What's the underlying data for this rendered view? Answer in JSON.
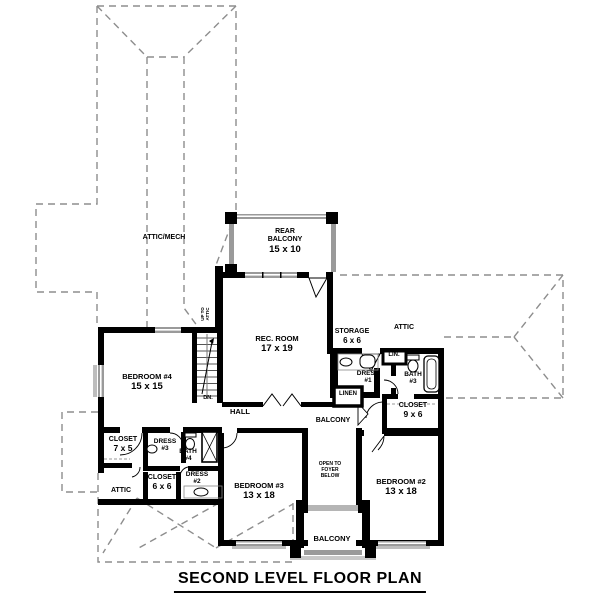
{
  "title": "SECOND LEVEL FLOOR PLAN",
  "colors": {
    "wall": "#000000",
    "window": "#9a9a9a",
    "railing": "#9a9a9a",
    "roof_dash": "#8d8d8d",
    "text": "#000000",
    "background": "#ffffff"
  },
  "plan": {
    "rooms": {
      "attic_mech": {
        "name": "ATTIC/MECH"
      },
      "rear_balcony": {
        "l1": "REAR",
        "l2": "BALCONY",
        "dim": "15 x 10"
      },
      "rec_room": {
        "name": "REC. ROOM",
        "dim": "17 x 19"
      },
      "storage": {
        "name": "STORAGE",
        "dim": "6 x 6"
      },
      "attic_right": {
        "name": "ATTIC"
      },
      "lin": {
        "name": "LIN."
      },
      "dress_1": {
        "name": "DRESS",
        "num": "#1"
      },
      "bath_3": {
        "name": "BATH",
        "num": "#3"
      },
      "linen": {
        "name": "LINEN"
      },
      "closet_9x6": {
        "name": "CLOSET",
        "dim": "9 x 6"
      },
      "hall": {
        "name": "HALL"
      },
      "bedroom_4": {
        "name": "BEDROOM #4",
        "dim": "15 x 15"
      },
      "closet_7x5": {
        "name": "CLOSET",
        "dim": "7 x 5"
      },
      "dress_3": {
        "name": "DRESS",
        "num": "#3"
      },
      "bath_4": {
        "name": "BATH",
        "num": "#4"
      },
      "closet_6x6": {
        "name": "CLOSET",
        "dim": "6 x 6"
      },
      "dress_2": {
        "name": "DRESS",
        "num": "#2"
      },
      "attic_left": {
        "name": "ATTIC"
      },
      "bedroom_3": {
        "name": "BEDROOM #3",
        "dim": "13 x 18"
      },
      "balcony_interior": {
        "name": "BALCONY"
      },
      "open_to_foyer": {
        "l1": "OPEN TO",
        "l2": "FOYER",
        "l3": "BELOW"
      },
      "bedroom_2": {
        "name": "BEDROOM #2",
        "dim": "13 x 18"
      },
      "balcony_front": {
        "name": "BALCONY"
      },
      "stairs": {
        "dn": "DN.",
        "up1": "UP TO",
        "up2": "ATTIC"
      }
    }
  }
}
